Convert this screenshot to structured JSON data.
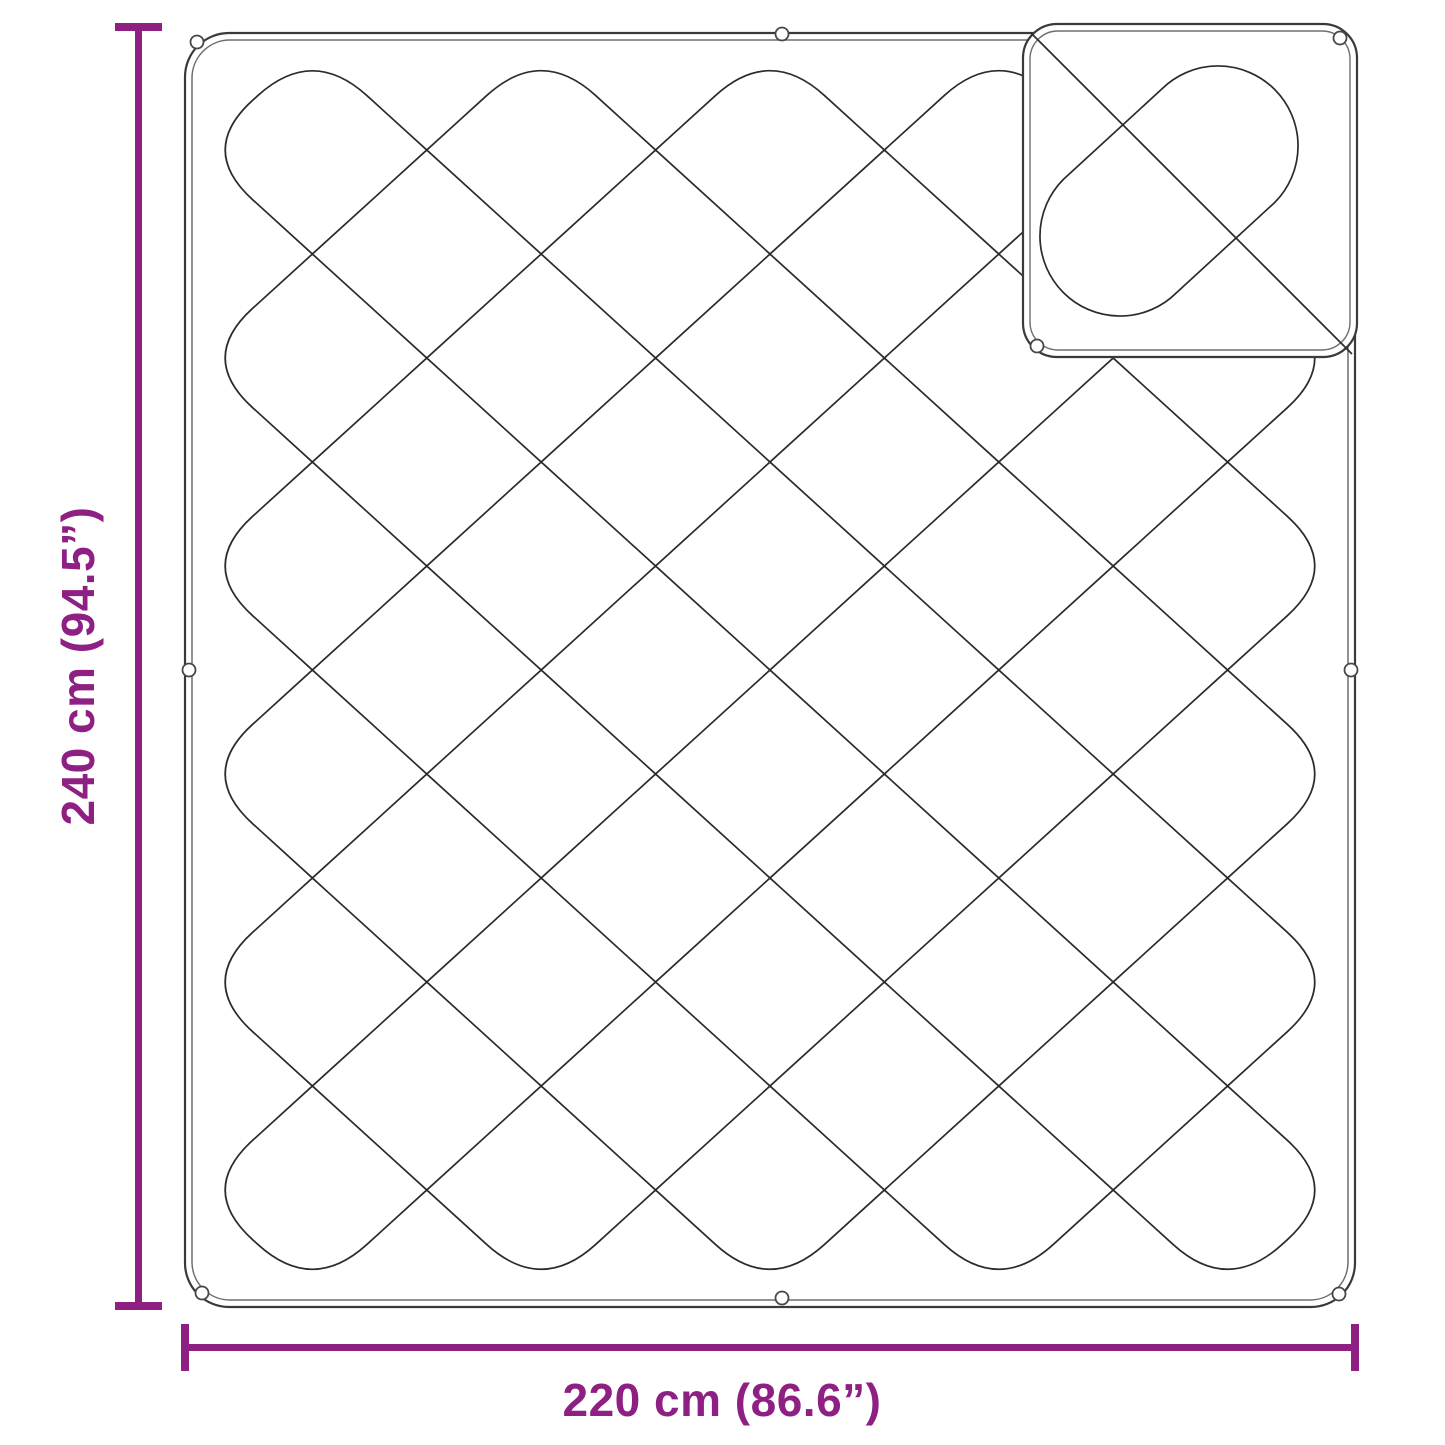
{
  "figure": {
    "name": "quilted-blanket-dimension-diagram"
  },
  "colors": {
    "dimension_accent": "#8E2083",
    "drawing_line": "#2b2b2b",
    "background": "#ffffff"
  },
  "dimensions": {
    "height": {
      "label": "240 cm (94.5”)",
      "cm": 240,
      "inches": 94.5
    },
    "width": {
      "label": "220 cm (86.6”)",
      "cm": 220,
      "inches": 86.6
    }
  }
}
